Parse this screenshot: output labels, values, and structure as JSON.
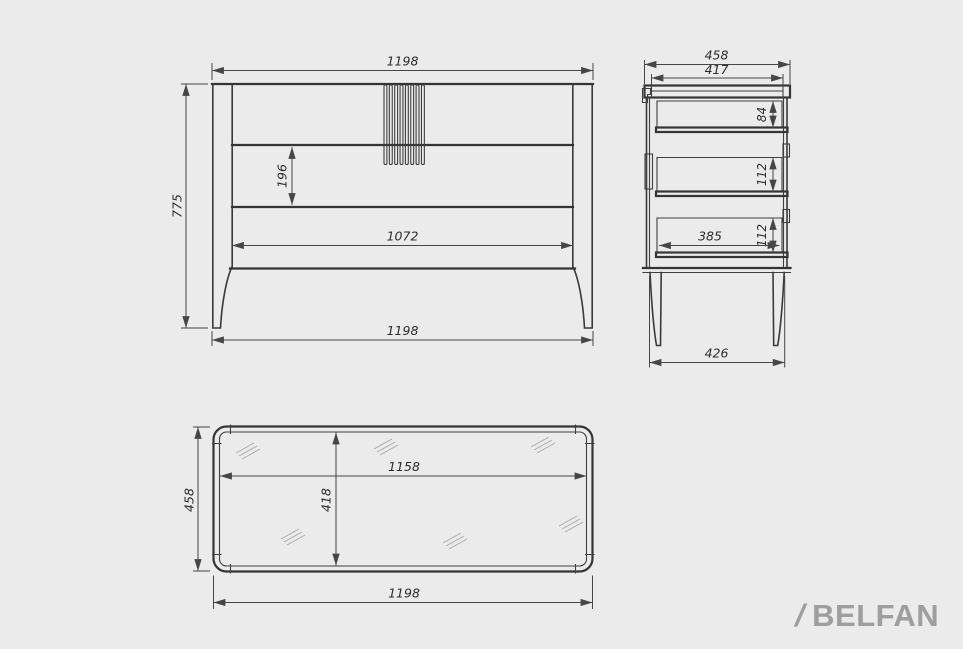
{
  "drawing": {
    "front": {
      "width_top": "1198",
      "height": "775",
      "drawer_height": "196",
      "inner_width": "1072",
      "width_bottom": "1198"
    },
    "side": {
      "depth": "458",
      "top_depth": "417",
      "drawer1_height": "84",
      "drawer2_height": "112",
      "drawer3_height": "112",
      "drawer_depth": "385",
      "base_depth": "426"
    },
    "top": {
      "depth": "458",
      "inner_width": "1158",
      "inner_depth": "418",
      "width": "1198"
    }
  },
  "branding": {
    "slash": "/",
    "name": "BELFAN"
  },
  "colors": {
    "background": "#ebebeb",
    "object_line": "#353535",
    "dimension_line": "#464646",
    "dimension_text": "#2c2c2c",
    "hatch": "#a9a9a9",
    "logo": "#9e9e9e"
  }
}
